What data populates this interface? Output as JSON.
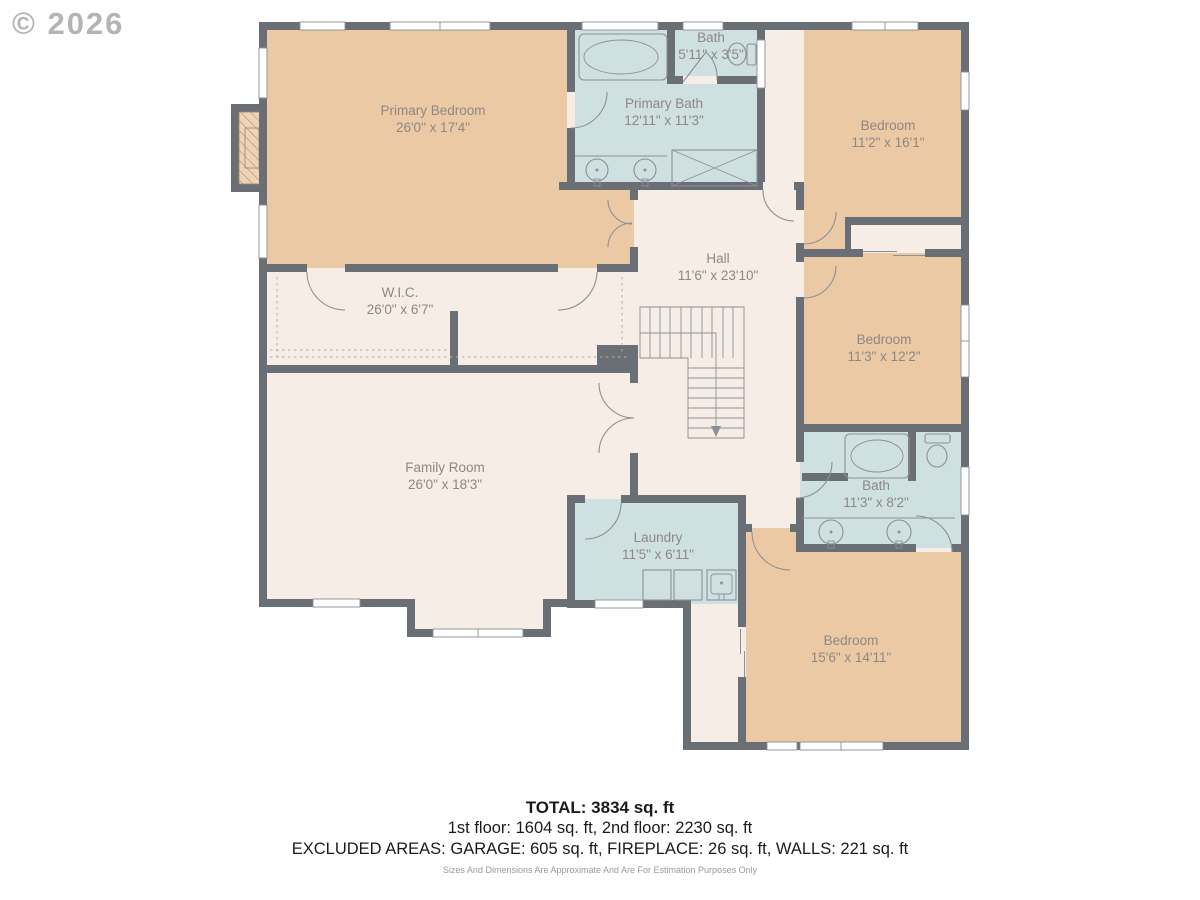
{
  "watermark": "© 2026",
  "colors": {
    "wall": "#6a6f76",
    "bedroom": "#ecc9a5",
    "bath": "#cfe0e1",
    "floor": "#f6eee6",
    "fixture": "#8a9096",
    "dashline": "#b9ab9c",
    "label": "#8d8881",
    "footer": "#1a1a1a",
    "disclaimer": "#9a9a9a",
    "watermark": "#a7a7a7"
  },
  "rooms": [
    {
      "name": "Primary Bedroom",
      "dims": "26'0\" x 17'4\""
    },
    {
      "name": "Primary Bath",
      "dims": "12'11\" x 11'3\""
    },
    {
      "name": "Bath",
      "dims": "5'11\" x 3'5\""
    },
    {
      "name": "Bedroom",
      "dims": "11'2\" x 16'1\""
    },
    {
      "name": "Hall",
      "dims": "11'6\" x 23'10\""
    },
    {
      "name": "W.I.C.",
      "dims": "26'0\" x 6'7\""
    },
    {
      "name": "Bedroom",
      "dims": "11'3\" x 12'2\""
    },
    {
      "name": "Family Room",
      "dims": "26'0\" x 18'3\""
    },
    {
      "name": "Bath",
      "dims": "11'3\" x 8'2\""
    },
    {
      "name": "Laundry",
      "dims": "11'5\" x 6'11\""
    },
    {
      "name": "Bedroom",
      "dims": "15'6\" x 14'11\""
    }
  ],
  "footer": {
    "total": "TOTAL: 3834 sq. ft",
    "floors": "1st floor: 1604 sq. ft, 2nd floor: 2230 sq. ft",
    "excluded": "EXCLUDED AREAS: GARAGE: 605 sq. ft, FIREPLACE: 26 sq. ft, WALLS: 221 sq. ft",
    "disclaimer": "Sizes And Dimensions Are Approximate And Are For Estimation Purposes Only"
  }
}
